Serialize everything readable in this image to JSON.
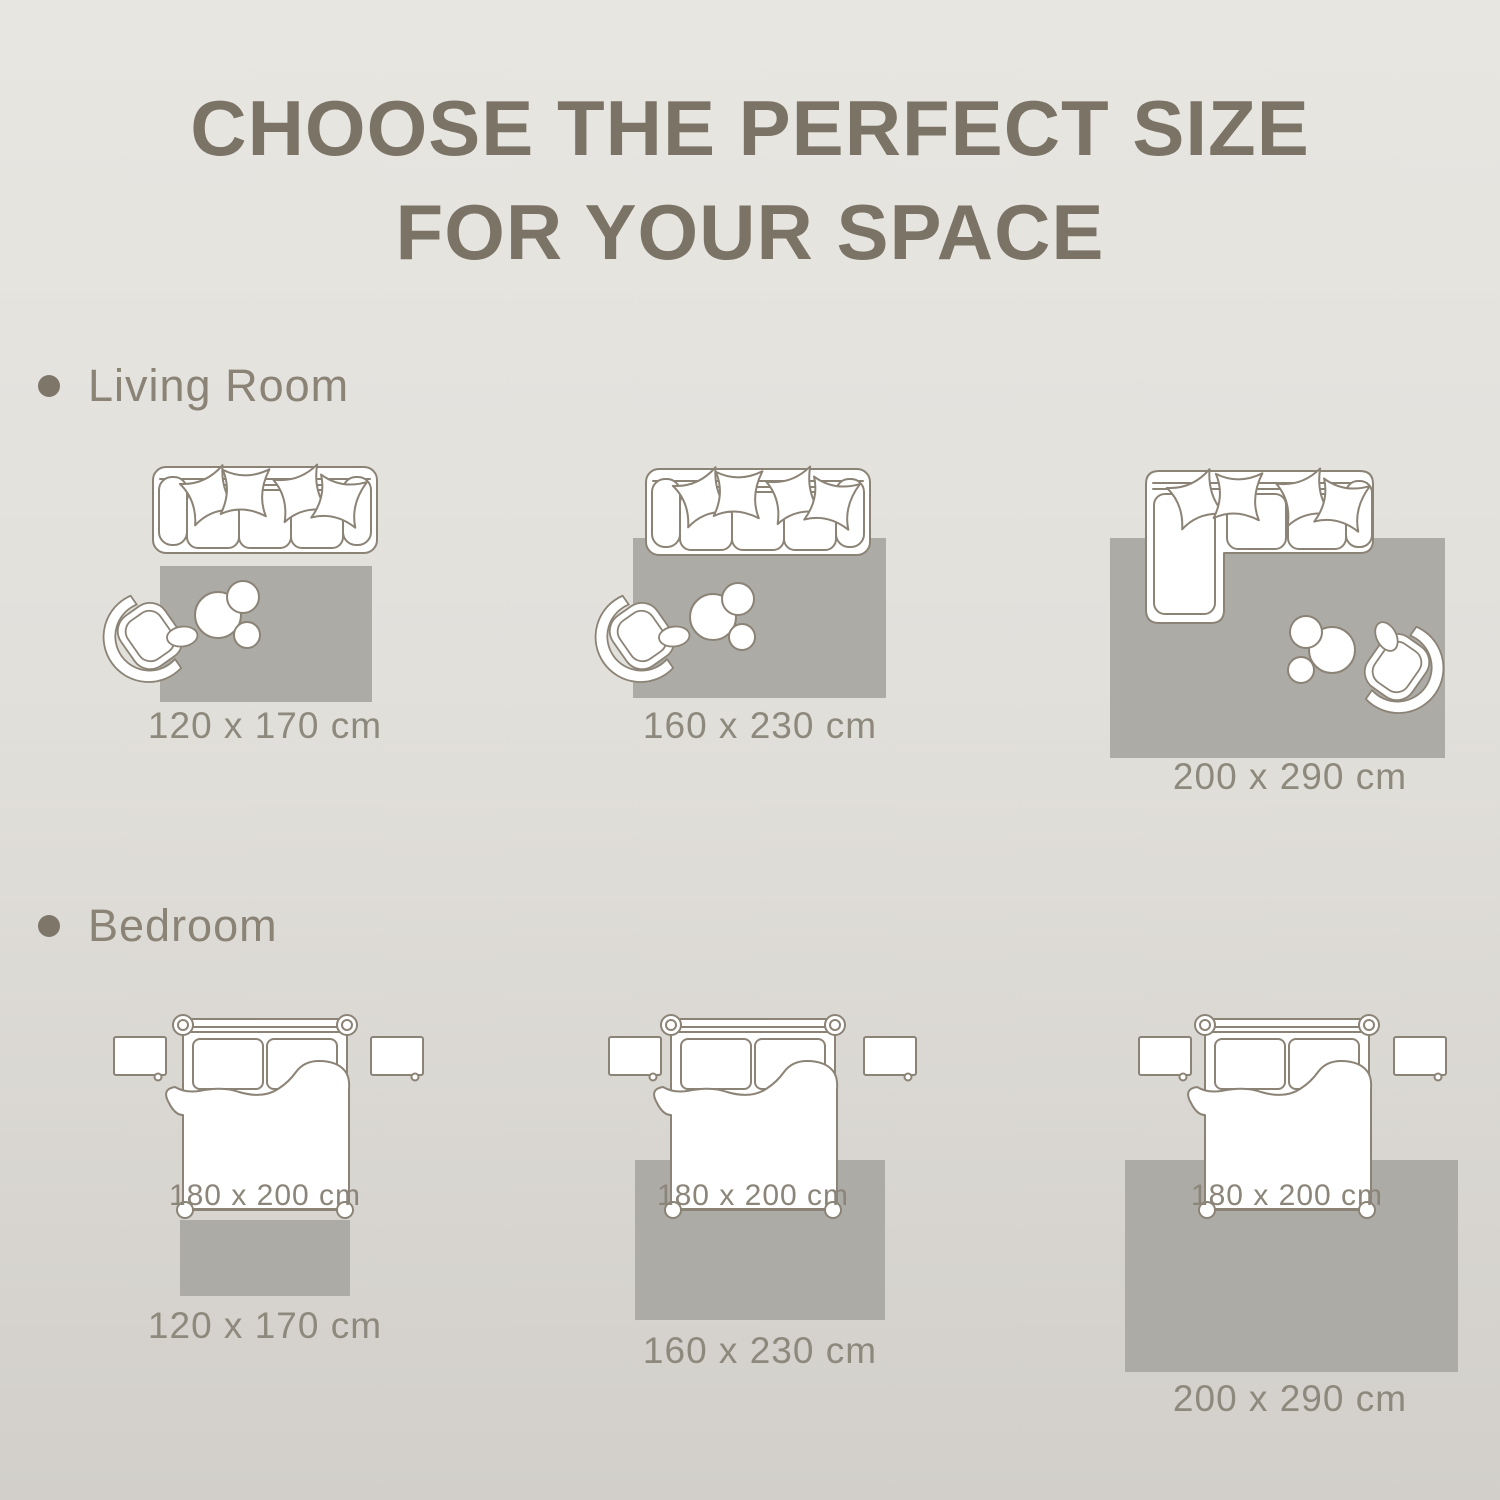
{
  "title": {
    "line1": "CHOOSE THE PERFECT SIZE",
    "line2": "FOR YOUR SPACE"
  },
  "sections": [
    {
      "label": "Living Room",
      "figures": [
        {
          "furniture": [
            "sofa",
            "armchair",
            "coffee-table"
          ],
          "rug_size": "120 x 170 cm"
        },
        {
          "furniture": [
            "sofa",
            "armchair",
            "coffee-table"
          ],
          "rug_size": "160 x 230 cm"
        },
        {
          "furniture": [
            "sectional-sofa",
            "armchair",
            "coffee-table"
          ],
          "rug_size": "200 x 290 cm"
        }
      ]
    },
    {
      "label": "Bedroom",
      "figures": [
        {
          "furniture": [
            "bed",
            "nightstand",
            "nightstand"
          ],
          "bed_size": "180 x 200 cm",
          "rug_size": "120 x 170 cm"
        },
        {
          "furniture": [
            "bed",
            "nightstand",
            "nightstand"
          ],
          "bed_size": "180 x 200 cm",
          "rug_size": "160 x 230 cm"
        },
        {
          "furniture": [
            "bed",
            "nightstand",
            "nightstand"
          ],
          "bed_size": "180 x 200 cm",
          "rug_size": "200 x 290 cm"
        }
      ]
    }
  ],
  "colors": {
    "background_top": "#e8e6e1",
    "background_bottom": "#d2cfca",
    "title_text": "#7b7365",
    "section_text": "#8a8376",
    "size_label_text": "#8e897d",
    "furniture_outline": "#8b8376",
    "furniture_fill": "#ffffff",
    "rug_fill": "#adaba6",
    "bullet": "#7d7669"
  }
}
